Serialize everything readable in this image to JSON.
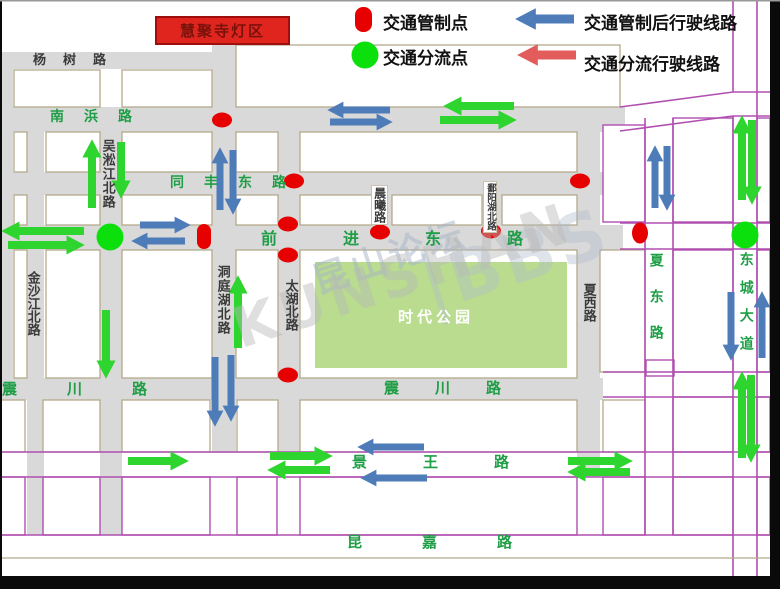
{
  "legend": {
    "item1": {
      "label": "交通管制点",
      "symbol": "red-oval"
    },
    "item2": {
      "label": "交通管制后行驶线路",
      "symbol": "blue-arrow"
    },
    "item3": {
      "label": "交通分流点",
      "symbol": "green-circle"
    },
    "item4": {
      "label": "交通分流行驶线路",
      "symbol": "red-arrow"
    }
  },
  "landmark": {
    "label": "慧聚寺灯区"
  },
  "park": {
    "label": "时代公园"
  },
  "watermark": {
    "cn": "昆山论坛",
    "bbs": "BBS",
    "en": "KUNSHAN"
  },
  "roads": {
    "yangshu": "杨树路",
    "nanbang": "南浜路",
    "wusongjiang": "吴淞江北路",
    "tongfeng": "同丰东路",
    "qianjin": "前进东路",
    "jinshajiang": "金沙江北路",
    "dongtinghu": "洞庭湖北路",
    "taihu": "太湖北路",
    "chenxi": "晨曦路",
    "poyanghu": "鄱阳湖北路",
    "xiaxi": "夏西路",
    "xiadong": "夏东路",
    "dongcheng": "东城大道",
    "zhenchuan_west": "震川路",
    "zhenchuan_mid": "震川路",
    "jingwang": "景王路",
    "kunjia": "昆嘉路"
  },
  "colors": {
    "control_point": "#e60000",
    "diversion_point": "#0ce00c",
    "control_route": "#4d7cb8",
    "diversion_route_map": "#2fd52f",
    "legend_red_arrow": "#e25c5c",
    "road_label_green": "#1f9e46",
    "purple_road": "#b04fb0",
    "landmark_bg": "#e0251e",
    "park_fill": "#b9dc8e",
    "road_gray": "#d9d9d9"
  }
}
